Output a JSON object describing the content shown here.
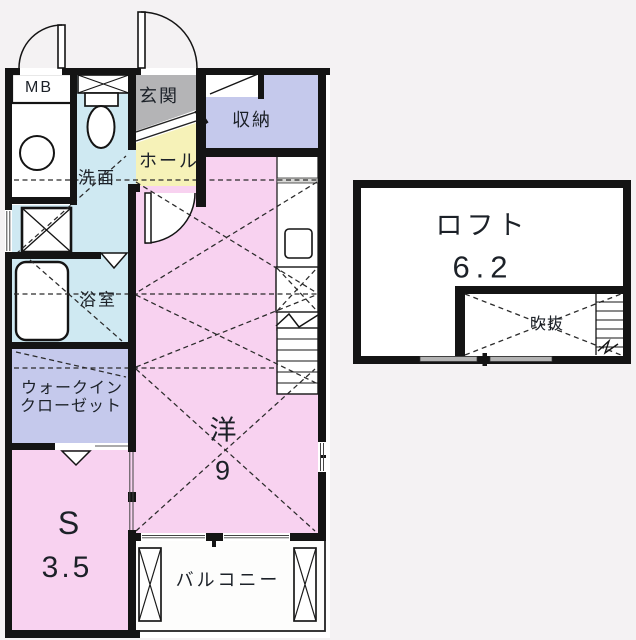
{
  "floorplan": {
    "labels": {
      "mb": "MB",
      "entrance": "玄関",
      "hall": "ホール",
      "storage": "収納",
      "washroom": "洗面",
      "bathroom": "浴室",
      "walkin_line1": "ウォークイン",
      "walkin_line2": "クローゼット",
      "western_room": "洋",
      "western_room_size": "9",
      "service_room": "S",
      "service_room_size": "3.5",
      "balcony": "バルコニー",
      "loft": "ロフト",
      "loft_size": "6.2",
      "void": "吹抜"
    },
    "colors": {
      "wall": "#141414",
      "room_pink": "#f8d2f0",
      "room_blue": "#cfe9f2",
      "room_lavender": "#c5c9ec",
      "room_yellow": "#f6f2b8",
      "room_gray": "#b4b4b6",
      "room_white": "#fefefe",
      "dash_line": "#2a2a2a",
      "text": "#1c2128",
      "background": "#f4f2f3"
    }
  }
}
